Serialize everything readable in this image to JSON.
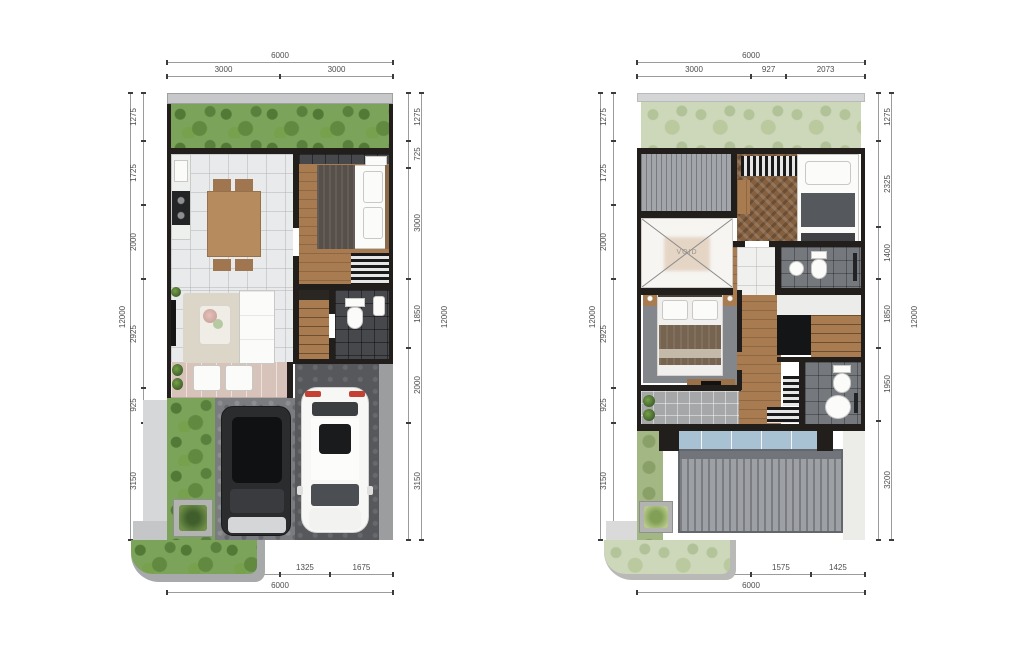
{
  "colors": {
    "wall": "#211e1c",
    "grass": "#7ca35a",
    "grass_pale": "#cdd8bb",
    "wood_floor": "#a87c50",
    "tile_light": "#e9eaeb",
    "tile_dark": "#46484c",
    "terrace_stone": "#d8c3bb",
    "driveway": "#56585b",
    "roof": "#9da0a4",
    "skylight": "#a9c2d3",
    "taillight_red": "#c44233",
    "dim_text": "#4d4d4d"
  },
  "ground_floor": {
    "dim_top": {
      "total": "6000",
      "segments": [
        "3000",
        "3000"
      ]
    },
    "dim_bottom": {
      "total": "6000",
      "segments": [
        "3000",
        "1325",
        "1675"
      ]
    },
    "dim_left": {
      "total": "12000",
      "segments": [
        "1275",
        "1725",
        "2000",
        "2925",
        "925",
        "3150"
      ]
    },
    "dim_right": {
      "total": "12000",
      "segments": [
        "1275",
        "725",
        "3000",
        "1850",
        "2000",
        "3150"
      ]
    }
  },
  "upper_floor": {
    "void_label": "VOID",
    "dim_top": {
      "total": "6000",
      "segments": [
        "3000",
        "927",
        "2073"
      ]
    },
    "dim_bottom": {
      "total": "6000",
      "segments": [
        "3000",
        "1575",
        "1425"
      ]
    },
    "dim_left": {
      "total": "12000",
      "segments": [
        "1275",
        "1725",
        "2000",
        "2925",
        "925",
        "3150"
      ]
    },
    "dim_right": {
      "total": "12000",
      "segments": [
        "1275",
        "2325",
        "1400",
        "1850",
        "1950",
        "3200"
      ]
    }
  }
}
